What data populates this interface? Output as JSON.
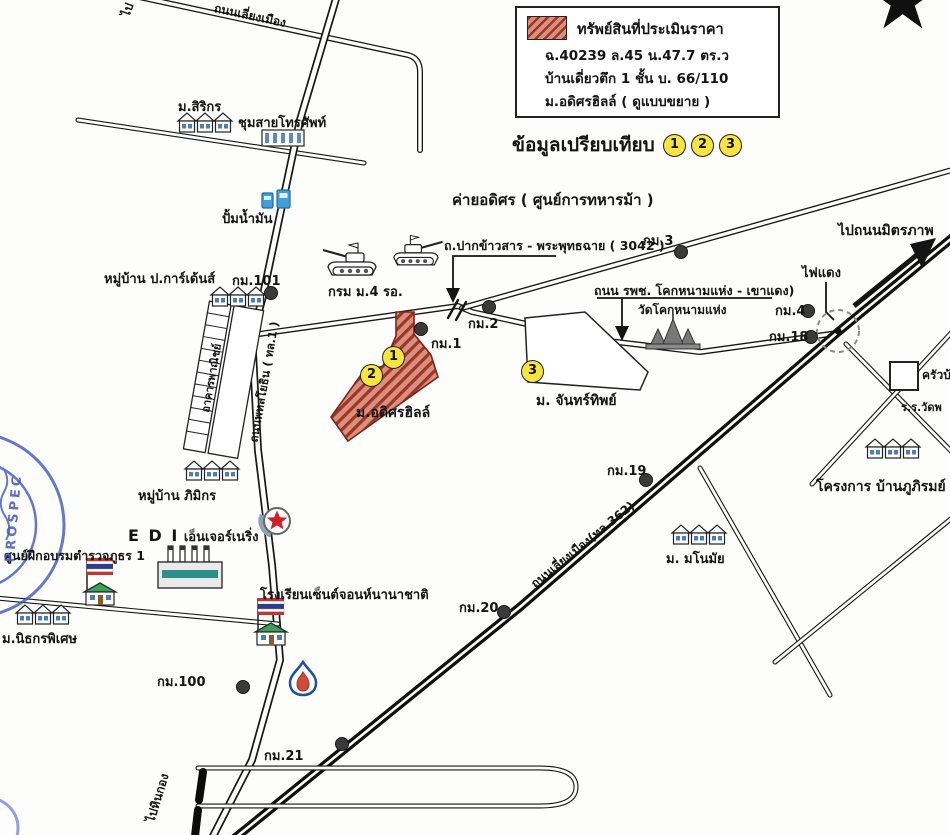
{
  "legend": {
    "title": "ทรัพย์สินที่ประเมินราคา",
    "line2": "ฉ.40239 ล.45 น.47.7 ตร.ว",
    "line3": "บ้านเดี่ยวตึก 1 ชั้น บ. 66/110",
    "line4": "ม.อดิศรฮิลล์ ( ดูแบบขยาย )"
  },
  "comparison": {
    "label": "ข้อมูลเปรียบเทียบ",
    "m1": "1",
    "m2": "2",
    "m3": "3"
  },
  "property_markers": {
    "m1": "1",
    "m2": "2",
    "m3": "3"
  },
  "roads": {
    "bypass_top": "ถนนเลี่ยงเมือง",
    "to_fragment": "ไป",
    "phahonyothin": "ถนนพหลโยธิน ( ทล.1 )",
    "pak_khao_san": "ถ.ปากข้าวสาร - พระพุทธฉาย ( 3042 )",
    "rpch": "ถนน รพช. โคกหนามแห่ง - เขาแดง)",
    "bypass_362": "ถนนเลี่ยงเมือง(ทล.362)",
    "to_mittraphap": "ไปถนนมิตรภาพ",
    "to_hinkong": "ไปหินกอง",
    "red_light": "ไฟแดง"
  },
  "places": {
    "sirikorn": "ม.สิริกร",
    "telephone_exchange": "ชุมสายโทรศัพท์",
    "gas_station": "ปั้มน้ำมัน",
    "p_gardens": "หมู่บ้าน ป.การ์เด้นส์",
    "cavalry_camp": "ค่ายอดิศร ( ศูนย์การทหารม้า )",
    "krom_m4": "กรม ม.4 รอ.",
    "wat_khok": "วัดโคกหนามแห่ง",
    "adisorn_hill": "ม.อดิศรฮิลล์",
    "chanthip": "ม. จันทร์ทิพย์",
    "shophouses": "อาคารพาณิชย์",
    "pimikorn": "หมู่บ้าน ภิมิกร",
    "edi_latin": "E D I",
    "edi_thai": "เอ็นเจอร์เนริ่ง",
    "police_academy": "ศูนย์ฝึกอบรมตำรวจภูธร 1",
    "nithikorn": "ม.นิธกรพิเศษ",
    "st_john": "โรงเรียนเซ็นต์จอนห์นานาชาติ",
    "manomai": "ม. มโนมัย",
    "phupirom": "โครงการ บ้านภูภิรมย์",
    "krua_ban": "ครัวบ้า",
    "wat_school": "ร.ร.วัดพ"
  },
  "km_markers": {
    "km1": "กม.1",
    "km2": "กม.2",
    "km3": "กม.3",
    "km4": "กม.4",
    "km18": "กม.18",
    "km19": "กม.19",
    "km20": "กม.20",
    "km21": "กม.21",
    "km100": "กม.100",
    "km101": "กม.101"
  },
  "stamp": {
    "text": "PROSPEC"
  },
  "colors": {
    "property_fill": "#d8917e",
    "property_hatch": "#9e3526",
    "marker_yellow": "#f6e53e",
    "stamp_blue": "#3f57c0",
    "pump_blue": "#3f9fd8",
    "factory_teal": "#2e8f8a"
  }
}
